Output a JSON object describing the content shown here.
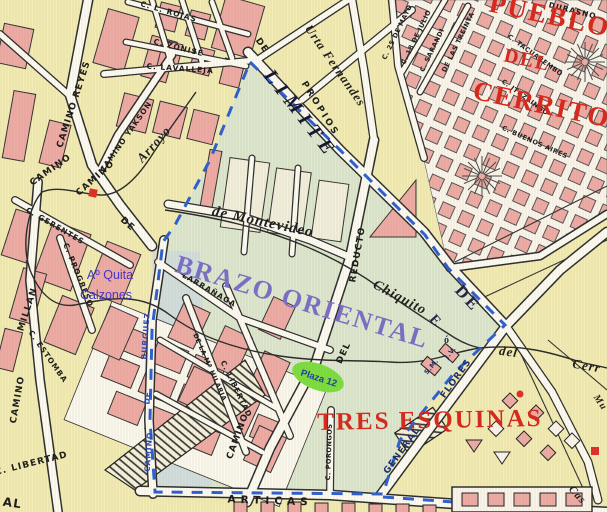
{
  "map": {
    "districts": {
      "pueblo": "PUEBLO",
      "del": "DEL",
      "cerrito": "CERRITO",
      "brazo_oriental": "BRAZO ORIENTAL",
      "tres_esquinas": "TRES ESQUINAS",
      "limite": "LIMITE",
      "de_big": "DE",
      "e_big": "E",
      "o_small": "ó"
    },
    "water": {
      "arroyo": "Arroyo",
      "montevideo": "de Montevideo",
      "chiquito": "Chiquito",
      "del_stream": "del",
      "cerrito_stream": "Cerr",
      "quita_line1": "Aº Quita",
      "quita_line2": "Calzones"
    },
    "places": {
      "plaza": "Plaza 12",
      "jv": "J.V.",
      "sm": "S.M."
    },
    "streets": [
      {
        "id": "camino-reyes",
        "text": "CAMINO REYES"
      },
      {
        "id": "rojas",
        "text": "C. L. ROJAS"
      },
      {
        "id": "zonise",
        "text": "C. ZONISE"
      },
      {
        "id": "lavalleja",
        "text": "C. LAVALLEJA"
      },
      {
        "id": "yakson",
        "text": "CAMINO YAKSON"
      },
      {
        "id": "camino-a",
        "text": "CAMINO"
      },
      {
        "id": "camino-b",
        "text": "CAMINO"
      },
      {
        "id": "de-small",
        "text": "DE"
      },
      {
        "id": "gerentes",
        "text": "C. GERENTES"
      },
      {
        "id": "progreso",
        "text": "C. PROGRESO"
      },
      {
        "id": "camino-millan",
        "text": "CAMINO"
      },
      {
        "id": "millan",
        "text": "MILLAN"
      },
      {
        "id": "estomba",
        "text": "C. ESTOMBA"
      },
      {
        "id": "libertad-sw",
        "text": "C. LIBERTAD"
      },
      {
        "id": "al",
        "text": "AL"
      },
      {
        "id": "camino-burguez",
        "text": "CAMINO"
      },
      {
        "id": "de-burguez",
        "text": "DE"
      },
      {
        "id": "burguez",
        "text": "BURGUEZ"
      },
      {
        "id": "larranaga",
        "text": "LARRAÑAGA"
      },
      {
        "id": "hilaria",
        "text": "DE LA Mª HILARIA"
      },
      {
        "id": "libertad-inner",
        "text": "C. LIBERTAD"
      },
      {
        "id": "camino-reducto",
        "text": "CAMINO"
      },
      {
        "id": "del-reducto",
        "text": "DEL"
      },
      {
        "id": "reducto",
        "text": "REDUCTO"
      },
      {
        "id": "articas",
        "text": "ARTICAS"
      },
      {
        "id": "porongos",
        "text": "C. PORONGOS"
      },
      {
        "id": "general",
        "text": "GENERAL"
      },
      {
        "id": "flores",
        "text": "FLORES"
      },
      {
        "id": "cas",
        "text": "Cas"
      },
      {
        "id": "mu",
        "text": "Mu"
      },
      {
        "id": "durasno",
        "text": "DURASNO"
      },
      {
        "id": "tacuarembo",
        "text": "C. TACUAREMBO"
      },
      {
        "id": "ituzaingo",
        "text": "C. ITUZAINGO"
      },
      {
        "id": "buenos-aires",
        "text": "C. BUENOS AIRES"
      },
      {
        "id": "25-de-mayo",
        "text": "C. 25 DE MAYO"
      },
      {
        "id": "18-de-julio",
        "text": "C. 18 DE JULIO"
      },
      {
        "id": "sarandi",
        "text": "C. SARANDI"
      },
      {
        "id": "treinta",
        "text": "DE LAS TREINTA"
      },
      {
        "id": "propios",
        "text": "PROPIOS"
      },
      {
        "id": "de-top",
        "text": "DE"
      },
      {
        "id": "urta",
        "text": "Urta Fernandes"
      }
    ],
    "colors": {
      "background": "#f2ecb4",
      "district_region": "#dde8cf",
      "boundary_dash_blue": "#2e5fd0",
      "block_pink": "#eeaca6",
      "district_red": "#d8281e",
      "brazo_violet": "#7b6ec8",
      "plaza_green": "#7ddf3f",
      "water_label_blue": "#4433cc"
    }
  }
}
